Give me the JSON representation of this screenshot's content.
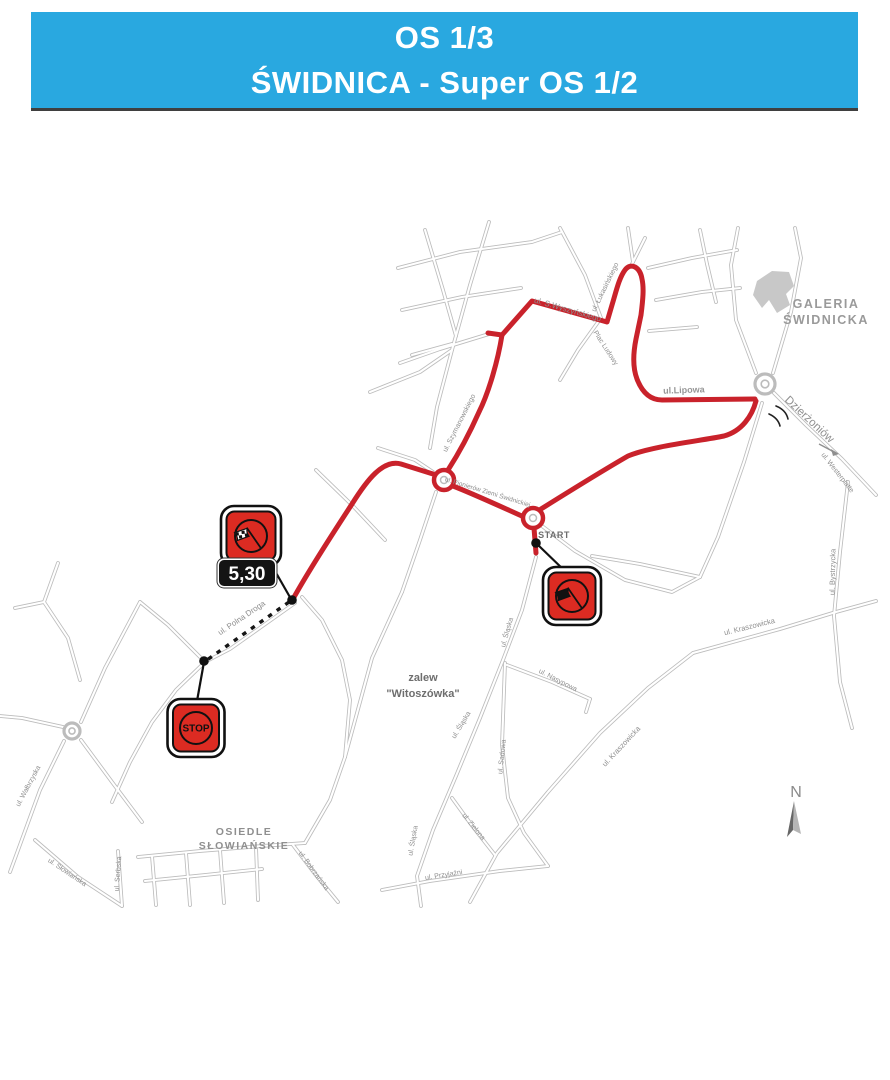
{
  "header": {
    "line1": "OS 1/3",
    "line2": "ŚWIDNICA - Super OS 1/2",
    "bg": "#29a8e0",
    "text_color": "#ffffff"
  },
  "map": {
    "road_casing_color": "#bcbcbc",
    "road_fill_color": "#ffffff",
    "route_color": "#c9222b",
    "sign_red": "#dc2b22",
    "label_default_color": "#8e8e8e",
    "building_fill": "#c8c8c8",
    "building_path": "M757,281 L772,271 L789,272 L794,286 L786,294 L790,305 L777,313 L769,300 L762,308 L753,295 Z",
    "roads": [
      "M489,222 L470,285 L452,350 L437,407 L430,448",
      "M398,268 L460,252 L532,242 L562,232",
      "M402,310 L462,297 L521,288",
      "M412,355 L452,344",
      "M425,230 L443,290 L456,336",
      "M370,392 L420,372 L452,350",
      "M489,334 L440,349 L400,363",
      "M560,228 L585,275 L601,318",
      "M601,318 L578,350 L560,380",
      "M645,238 L631,266",
      "M633,262 L628,228",
      "M648,268 L692,258 L737,250",
      "M656,300 L702,292 L740,288",
      "M649,331 L697,327",
      "M738,228 L731,265 L736,320 L756,373",
      "M795,228 L801,258 L791,312 L773,373",
      "M700,230 L707,264 L716,302",
      "M774,393 L806,425 L842,459 L876,495",
      "M848,482 L840,552 L834,616 L840,682 L852,728",
      "M693,653 L780,629 L836,612 L876,601",
      "M693,653 L648,688 L600,733 L548,792 L497,853 L470,902",
      "M762,403 L744,462 L718,537 L700,577",
      "M700,577 L640,564 L592,556",
      "M542,526 L575,551 L625,580 L672,592 L700,577",
      "M536,557 L522,610 L503,660 L480,718 L456,776 L433,830 L417,876 L421,906",
      "M505,663 L502,745 L508,798 L524,833 L548,866",
      "M507,665 L552,682 L590,699",
      "M590,699 L586,712",
      "M548,866 L500,871 L430,881 L382,890",
      "M452,798 L473,827 L495,855",
      "M295,603 L230,649 L205,662",
      "M205,662 L176,690 L152,722 L130,762 L112,802",
      "M205,662 L168,625 L140,602",
      "M140,602 L105,668 L81,722",
      "M64,741 L40,790 L21,842 L10,872",
      "M63,727 L22,718 L0,716",
      "M81,740 L112,782 L142,822",
      "M58,563 L44,602 L68,638 L80,680",
      "M44,602 L15,608",
      "M35,840 L78,877 L122,906",
      "M118,851 L122,906",
      "M138,857 L200,851 L262,846 L305,843",
      "M145,881 L205,875 L262,869",
      "M152,856 L156,905",
      "M186,853 L190,905",
      "M220,850 L224,903",
      "M256,847 L258,900",
      "M293,845 L315,874 L338,902",
      "M345,757 L330,800 L305,843",
      "M345,757 L350,700 L342,660 L322,620 L302,597",
      "M436,492 L420,540 L402,592",
      "M402,592 L372,658 L345,757",
      "M378,448 L415,460 L433,472",
      "M316,470 L352,505 L385,540"
    ],
    "route_paths": [
      "M536,553 L534,528",
      "M541,509 C565,494 602,471 628,456 C652,446 700,441 724,436 C742,431 752,416 756,401",
      "M755,399 L662,400 C650,400 642,392 637,379 C632,366 634,349 636,339 L641,315 C643,299 644,288 642,279 C640,267 631,262 625,270 C619,278 616,292 612,305 L607,322 L532,301 L502,335",
      "M502,335 L488,333",
      "M502,335 C498,360 489,392 479,412 C471,430 459,453 448,470",
      "M453,486 C476,495 506,509 524,517",
      "M433,474 L401,464 C383,459 367,480 352,504 C335,530 309,570 293,599"
    ],
    "roundabouts": [
      {
        "cx": 444,
        "cy": 480,
        "r": 10,
        "route": true
      },
      {
        "cx": 533,
        "cy": 518,
        "r": 10,
        "route": true
      },
      {
        "cx": 765,
        "cy": 384,
        "r": 10,
        "route": false
      },
      {
        "cx": 72,
        "cy": 731,
        "r": 8,
        "route": false
      }
    ],
    "dashed_section": "M289,602 L207,660",
    "leader_lines": [
      "M537,544 L567,573",
      "M267,557 L291,599",
      "M204,662 L197,701"
    ],
    "route_dots": [
      [
        536,
        543
      ],
      [
        292,
        600
      ],
      [
        204,
        661
      ]
    ],
    "signs": {
      "finish": {
        "cx": 251,
        "cy": 536,
        "w": 60,
        "h": 60,
        "type": "checkered-flag"
      },
      "start": {
        "cx": 572,
        "cy": 596,
        "w": 58,
        "h": 58,
        "type": "black-flag"
      },
      "stop": {
        "cx": 196,
        "cy": 728,
        "w": 57,
        "h": 58,
        "type": "text",
        "text": "STOP"
      }
    },
    "distance_plate": {
      "cx": 247,
      "cy": 573,
      "w": 56,
      "h": 26,
      "text": "5,30"
    },
    "north": {
      "label": "N",
      "x": 796,
      "y": 797
    },
    "dzierzoniow_arrow": "M819,444 L836,453",
    "roundabout_marks": [
      "M776,406 Q786,410 788,419",
      "M769,414 Q778,418 780,426"
    ],
    "labels": [
      {
        "text": "ul. S.Wyszyńskiego",
        "x": 567,
        "y": 312,
        "rot": 16,
        "size": 8
      },
      {
        "text": "ul. Szymanowskiego",
        "x": 461,
        "y": 424,
        "rot": -63,
        "size": 7
      },
      {
        "text": "Plac Ludowy",
        "x": 604,
        "y": 349,
        "rot": 57,
        "size": 7
      },
      {
        "text": "ul. Łukasińskiego",
        "x": 607,
        "y": 288,
        "rot": -64,
        "size": 7
      },
      {
        "text": "ul.Lipowa",
        "x": 684,
        "y": 393,
        "rot": -2,
        "size": 9,
        "weight": "bold",
        "color": "#979797"
      },
      {
        "text": "ul. Pionierów Ziemi Świdnickiej",
        "x": 487,
        "y": 494,
        "rot": 17,
        "size": 6.5
      },
      {
        "text": "START",
        "x": 554,
        "y": 538,
        "rot": 0,
        "size": 9,
        "weight": "bold",
        "color": "#6d6d6d",
        "ls": 0.5
      },
      {
        "text": "Dzierżoniów",
        "x": 807,
        "y": 422,
        "rot": 43,
        "size": 11.5,
        "color": "#8f8f8f"
      },
      {
        "text": "ul. Westerplatte",
        "x": 836,
        "y": 474,
        "rot": 52,
        "size": 7
      },
      {
        "text": "ul. Bystrzycka",
        "x": 835,
        "y": 572,
        "rot": -89,
        "size": 7.5
      },
      {
        "text": "ul. Kraszowicka",
        "x": 750,
        "y": 629,
        "rot": -14,
        "size": 7.5
      },
      {
        "text": "ul. Kraszowicka",
        "x": 623,
        "y": 748,
        "rot": -47,
        "size": 7.5
      },
      {
        "text": "ul. Nasypowa",
        "x": 557,
        "y": 682,
        "rot": 27,
        "size": 7
      },
      {
        "text": "ul. Sadowa",
        "x": 504,
        "y": 757,
        "rot": -84,
        "size": 7
      },
      {
        "text": "ul. Śląska",
        "x": 463,
        "y": 726,
        "rot": -59,
        "size": 7
      },
      {
        "text": "ul. Śląska",
        "x": 509,
        "y": 633,
        "rot": -74,
        "size": 7
      },
      {
        "text": "ul. Śląska",
        "x": 415,
        "y": 841,
        "rot": -80,
        "size": 7
      },
      {
        "text": "ul. Zielona",
        "x": 472,
        "y": 828,
        "rot": 51,
        "size": 7
      },
      {
        "text": "ul. Przyjaźni",
        "x": 444,
        "y": 877,
        "rot": -9,
        "size": 7
      },
      {
        "text": "ul. Polna Droga",
        "x": 243,
        "y": 620,
        "rot": -34,
        "size": 8
      },
      {
        "text": "ul. Wałbrzyska",
        "x": 30,
        "y": 787,
        "rot": -62,
        "size": 7
      },
      {
        "text": "ul. Słowiańska",
        "x": 66,
        "y": 874,
        "rot": 34,
        "size": 7
      },
      {
        "text": "ul. Serbska",
        "x": 120,
        "y": 874,
        "rot": -86,
        "size": 7
      },
      {
        "text": "ul. Bobrzańska",
        "x": 312,
        "y": 872,
        "rot": 54,
        "size": 7
      },
      {
        "text": "GALERIA",
        "x": 826,
        "y": 308,
        "rot": 0,
        "size": 12.5,
        "weight": "bold",
        "color": "#9a9a9a",
        "ls": 1.5
      },
      {
        "text": "ŚWIDNICKA",
        "x": 826,
        "y": 324,
        "rot": 0,
        "size": 12.5,
        "weight": "bold",
        "color": "#9a9a9a",
        "ls": 1.5
      },
      {
        "text": "OSIEDLE",
        "x": 244,
        "y": 835,
        "rot": 0,
        "size": 10.5,
        "weight": "bold",
        "color": "#8f8f8f",
        "ls": 1.5
      },
      {
        "text": "SŁOWIAŃSKIE",
        "x": 244,
        "y": 849,
        "rot": 0,
        "size": 10.5,
        "weight": "bold",
        "color": "#8f8f8f",
        "ls": 1.5
      },
      {
        "text": "zalew",
        "x": 423,
        "y": 681,
        "rot": 0,
        "size": 11,
        "weight": "bold",
        "color": "#6e6e6e"
      },
      {
        "text": "\"Witoszówka\"",
        "x": 423,
        "y": 697,
        "rot": 0,
        "size": 11,
        "weight": "bold",
        "color": "#6e6e6e"
      }
    ]
  }
}
